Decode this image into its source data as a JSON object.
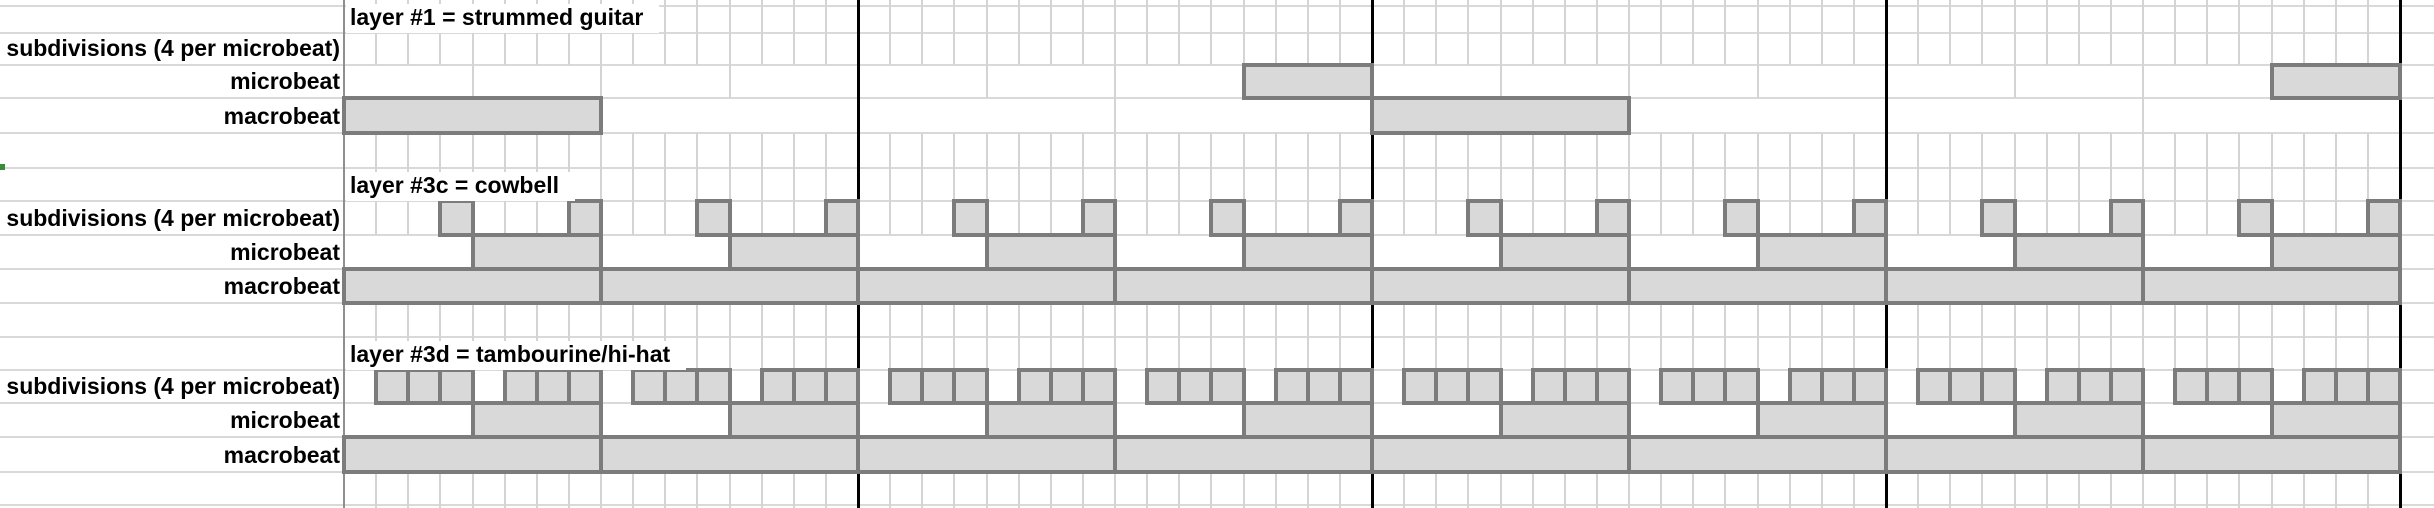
{
  "row_labels": {
    "subdivisions": "subdivisions (4 per microbeat)",
    "microbeat": "microbeat",
    "macrobeat": "macrobeat"
  },
  "grid": {
    "measures": 4,
    "macrobeats_per_measure": 2,
    "microbeats_per_macrobeat": 2,
    "subdivisions_per_microbeat": 4,
    "total_subdivisions": 64,
    "total_microbeats": 16,
    "total_macrobeats": 8
  },
  "colors": {
    "cell_fill": "#d9d9d9",
    "cell_border": "#7c7c7c",
    "gridline": "#d4d4d4",
    "measure_line": "#000000",
    "left_marker_green": "#3a8a3c"
  },
  "layers": [
    {
      "id": "layer-1",
      "title": "layer #1 = strummed guitar",
      "subdivisions_shaded": [],
      "microbeats_shaded": [
        8,
        16
      ],
      "macrobeats_shaded": [
        1,
        5
      ]
    },
    {
      "id": "layer-3c",
      "title": "layer #3c = cowbell",
      "subdivisions_shaded": [
        4,
        8,
        12,
        16,
        20,
        24,
        28,
        32,
        36,
        40,
        44,
        48,
        52,
        56,
        60,
        64
      ],
      "microbeats_shaded": [
        2,
        4,
        6,
        8,
        10,
        12,
        14,
        16
      ],
      "macrobeats_shaded": [
        1,
        2,
        3,
        4,
        5,
        6,
        7,
        8
      ]
    },
    {
      "id": "layer-3d",
      "title": "layer #3d = tambourine/hi-hat",
      "subdivisions_shaded": [
        2,
        3,
        4,
        6,
        7,
        8,
        10,
        11,
        12,
        14,
        15,
        16,
        18,
        19,
        20,
        22,
        23,
        24,
        26,
        27,
        28,
        30,
        31,
        32,
        34,
        35,
        36,
        38,
        39,
        40,
        42,
        43,
        44,
        46,
        47,
        48,
        50,
        51,
        52,
        54,
        55,
        56,
        58,
        59,
        60,
        62,
        63,
        64
      ],
      "microbeats_shaded": [
        2,
        4,
        6,
        8,
        10,
        12,
        14,
        16
      ],
      "macrobeats_shaded": [
        1,
        2,
        3,
        4,
        5,
        6,
        7,
        8
      ]
    }
  ]
}
